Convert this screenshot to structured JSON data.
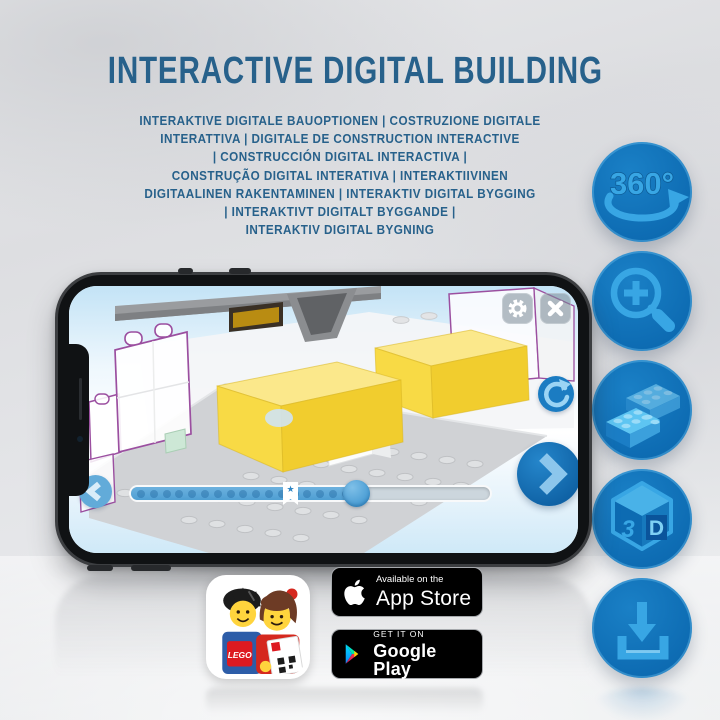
{
  "title": "INTERACTIVE DIGITAL BUILDING",
  "subtitle": {
    "lines": [
      "INTERAKTIVE DIGITALE BAUOPTIONEN | COSTRUZIONE DIGITALE",
      "INTERATTIVA | DIGITALE DE CONSTRUCTION INTERACTIVE",
      "| CONSTRUCCIÓN DIGITAL INTERACTIVA |",
      "CONSTRUÇÃO DIGITAL INTERATIVA | INTERAKTIIVINEN",
      "DIGITAALINEN RAKENTAMINEN | INTERAKTIV DIGITAL BYGGING",
      "| INTERAKTIVT DIGITALT BYGGANDE |",
      "INTERAKTIV DIGITAL BYGNING"
    ]
  },
  "features": {
    "rotate_label": "360°",
    "cube_left": "3",
    "cube_right": "D"
  },
  "phone_app": {
    "progress_percent": 62,
    "bookmark_percent": 43,
    "bookmark_star": "★"
  },
  "store": {
    "lego_logo": "LEGO",
    "app_store": {
      "tagline": "Available on the",
      "name": "App Store"
    },
    "google_play": {
      "tagline": "GET IT ON",
      "name": "Google Play"
    }
  },
  "colors": {
    "headline": "#27618b",
    "feature_circle": "#0e6fb6",
    "feature_icon": "#38a6e4",
    "app_blue": "#1b79be",
    "lego_yellow": "#f5d63e",
    "lego_red": "#dd1a21",
    "ghost_outline": "#9b4fa0"
  }
}
